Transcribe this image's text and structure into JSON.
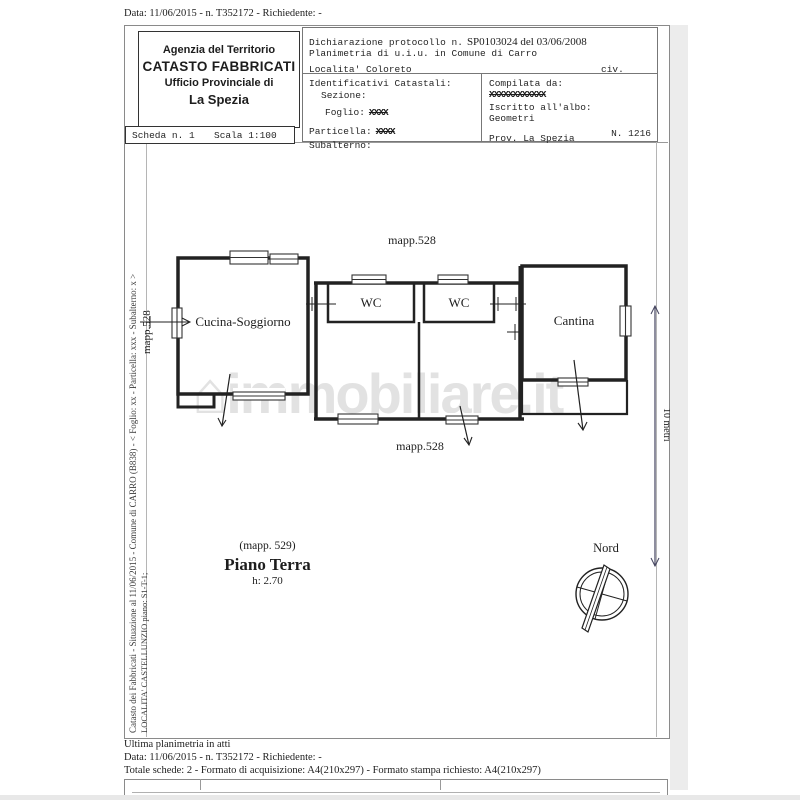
{
  "top_line": "Data: 11/06/2015 - n. T352172 - Richiedente: -",
  "header": {
    "agency": {
      "line1": "Agenzia del Territorio",
      "line2": "CATASTO FABBRICATI",
      "line3": "Ufficio Provinciale di",
      "line4": "La Spezia"
    },
    "scheda": {
      "number": "Scheda n. 1",
      "scale": "Scala 1:100"
    },
    "declaration": {
      "protocol_label": "Dichiarazione protocollo n.",
      "protocol_value": "SP0103024 del 03/06/2008",
      "planimetria": "Planimetria di u.i.u. in Comune di Carro",
      "localita": "Localita' Coloreto",
      "civ": "civ."
    },
    "identificativi": {
      "title": "Identificativi Catastali:",
      "sezione": "Sezione:",
      "foglio_label": "Foglio:",
      "foglio_value": "XXXX",
      "particella_label": "Particella:",
      "particella_value": "XXXX",
      "subalterno": "Subalterno:"
    },
    "compilata": {
      "label": "Compilata da:",
      "name_redacted": "XXXXXXXXXXXX",
      "albo_label": "Iscritto all'albo:",
      "albo_value": "Geometri",
      "prov": "Prov. La Spezia",
      "numero": "N. 1216"
    }
  },
  "plan": {
    "mapp_top": "mapp.528",
    "mapp_left": "mapp.528",
    "mapp_bottom": "mapp.528",
    "rooms": {
      "kitchen": "Cucina-Soggiorno",
      "wc1": "WC",
      "wc2": "WC",
      "cantina": "Cantina"
    },
    "caption": {
      "mapp": "(mapp. 529)",
      "floor": "Piano Terra",
      "height": "h: 2.70"
    },
    "compass_label": "Nord",
    "scale_bar_label": "10 metri"
  },
  "side_text": {
    "line1": "Catasto dei Fabbricati - Situazione al 11/06/2015 - Comune di CARRO (B838) - < Foglio: xx - Particella: xxx - Subalterno: x >",
    "line2": "LOCALITA' CASTELLUNZIO piano: S1-T-1;"
  },
  "watermark": "immobiliare.it",
  "footer": {
    "line1": "Ultima planimetria in atti",
    "line2": "Data: 11/06/2015 - n. T352172 - Richiedente: -",
    "line3": "Totale schede: 2 - Formato di acquisizione: A4(210x297)  - Formato stampa richiesto: A4(210x297)"
  },
  "colors": {
    "ink": "#1d1d1d",
    "frame": "#8a8a8a",
    "watermark": "#cccccc",
    "scale_bar_text": "#5c5c82"
  }
}
